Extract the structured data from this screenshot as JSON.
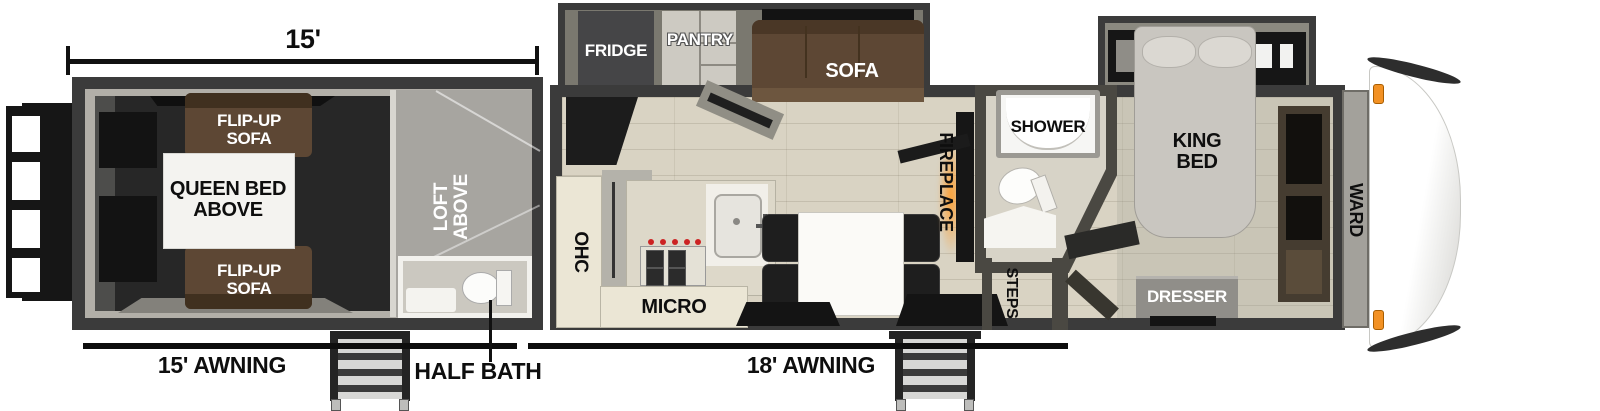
{
  "dimension": {
    "length_label": "15'"
  },
  "garage": {
    "flip_up_sofa_top": "FLIP-UP\nSOFA",
    "queen_bed_above": "QUEEN BED\nABOVE",
    "flip_up_sofa_bottom": "FLIP-UP\nSOFA",
    "loft_above": "LOFT\nABOVE",
    "half_bath": "HALF BATH"
  },
  "kitchen": {
    "fridge": "FRIDGE",
    "pantry": "PANTRY",
    "sofa": "SOFA",
    "ohc": "OHC",
    "micro": "MICRO",
    "fireplace": "FIREPLACE"
  },
  "bathroom": {
    "shower": "SHOWER",
    "steps": "STEPS"
  },
  "bedroom": {
    "king_bed": "KING\nBED",
    "ward": "WARD",
    "dresser": "DRESSER"
  },
  "awnings": {
    "left": "15' AWNING",
    "right": "18' AWNING"
  },
  "colors": {
    "wall_dark": "#3b3b3b",
    "slide_gray": "#7a786f",
    "sofa_brown": "#5d4734",
    "wood_floor": "#d9d3c3",
    "garage_floor": "#272727",
    "loft_gray": "#a7a5a0",
    "cabinet_cream": "#ebe6d5",
    "marker_orange": "#f29124",
    "fireplace_glow": "#ff9c2a"
  }
}
